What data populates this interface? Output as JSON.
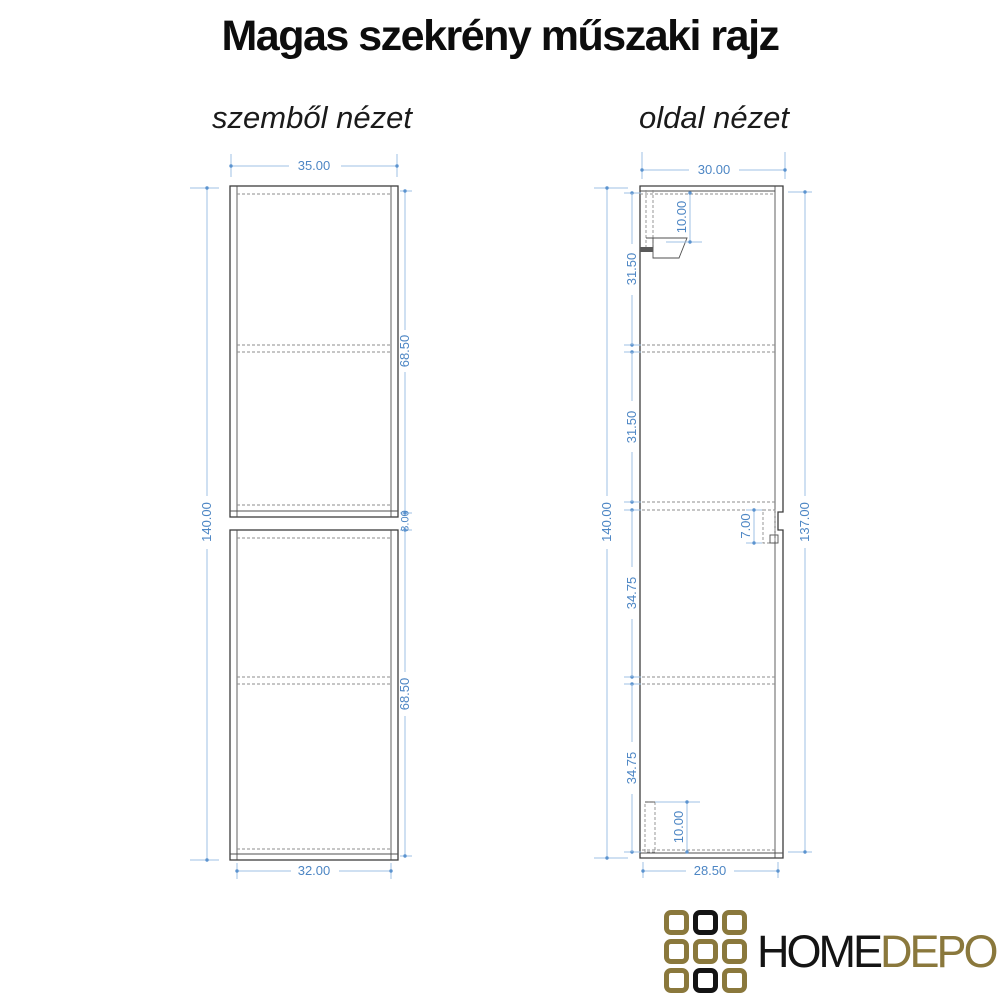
{
  "title": "Magas szekrény műszaki rajz",
  "front_view": {
    "label": "szemből nézet",
    "dims": {
      "top_width": "35.00",
      "total_height": "140.00",
      "upper_height": "68.50",
      "middle_gap": "3.00",
      "lower_height": "68.50",
      "bottom_width": "32.00"
    }
  },
  "side_view": {
    "label": "oldal nézet",
    "dims": {
      "top_depth": "30.00",
      "total_height": "140.00",
      "right_height": "137.00",
      "section_1": "31.50",
      "section_2": "31.50",
      "section_3": "34.75",
      "section_4": "34.75",
      "top_bracket": "10.00",
      "connector": "7.00",
      "bottom_bracket": "10.00",
      "bottom_depth": "28.50"
    }
  },
  "logo": {
    "text_primary": "HOME",
    "text_secondary": "DEPO",
    "grid_pattern": [
      "gold",
      "black",
      "gold",
      "gold",
      "gold",
      "gold",
      "gold",
      "black",
      "gold"
    ]
  },
  "colors": {
    "dimension_text": "#4d86c4",
    "dimension_line": "#9fc2e5",
    "drawing_line": "#3d3d3d",
    "hidden_line": "#8c8c8c",
    "logo_gold": "#8a783c",
    "logo_black": "#141414"
  }
}
